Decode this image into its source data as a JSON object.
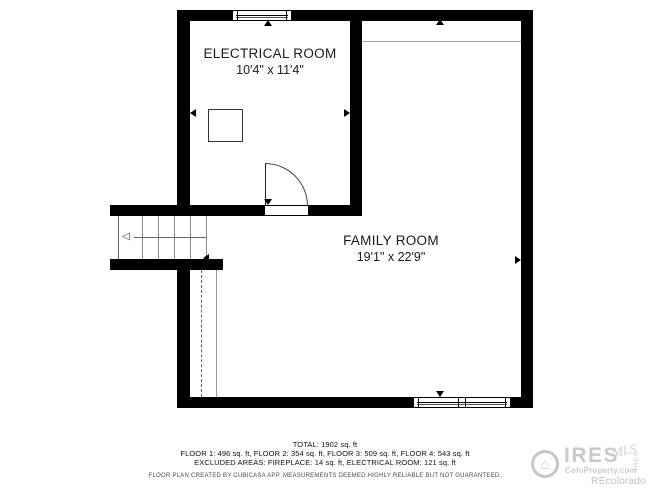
{
  "plan": {
    "electrical_room": {
      "label": "ELECTRICAL ROOM",
      "dims": "10'4\" x 11'4\""
    },
    "family_room": {
      "label": "FAMILY ROOM",
      "dims": "19'1\" x 22'9\""
    }
  },
  "summary": {
    "total": "TOTAL: 1902 sq. ft",
    "floors": "FLOOR 1: 496 sq. ft, FLOOR 2: 354 sq. ft, FLOOR 3: 509 sq. ft, FLOOR 4: 543 sq. ft",
    "excluded": "EXCLUDED AREAS: FIREPLACE: 14 sq. ft, ELECTRICAL ROOM: 121 sq. ft",
    "disclaimer": "FLOOR PLAN CREATED BY CUBICASA APP. MEASUREMENTS DEEMED HIGHLY RELIABLE BUT NOT GUARANTEED."
  },
  "watermark": {
    "brand": "IRES",
    "script": "MLS",
    "site": "ColoProperty.com",
    "org": "REcolorado",
    "vertical_text": "IRES"
  },
  "icons": {
    "stair_direction": "◁",
    "house": "⌂"
  },
  "colors": {
    "wall": "#000000",
    "background": "#ffffff",
    "watermark": "#c8c8c8"
  }
}
